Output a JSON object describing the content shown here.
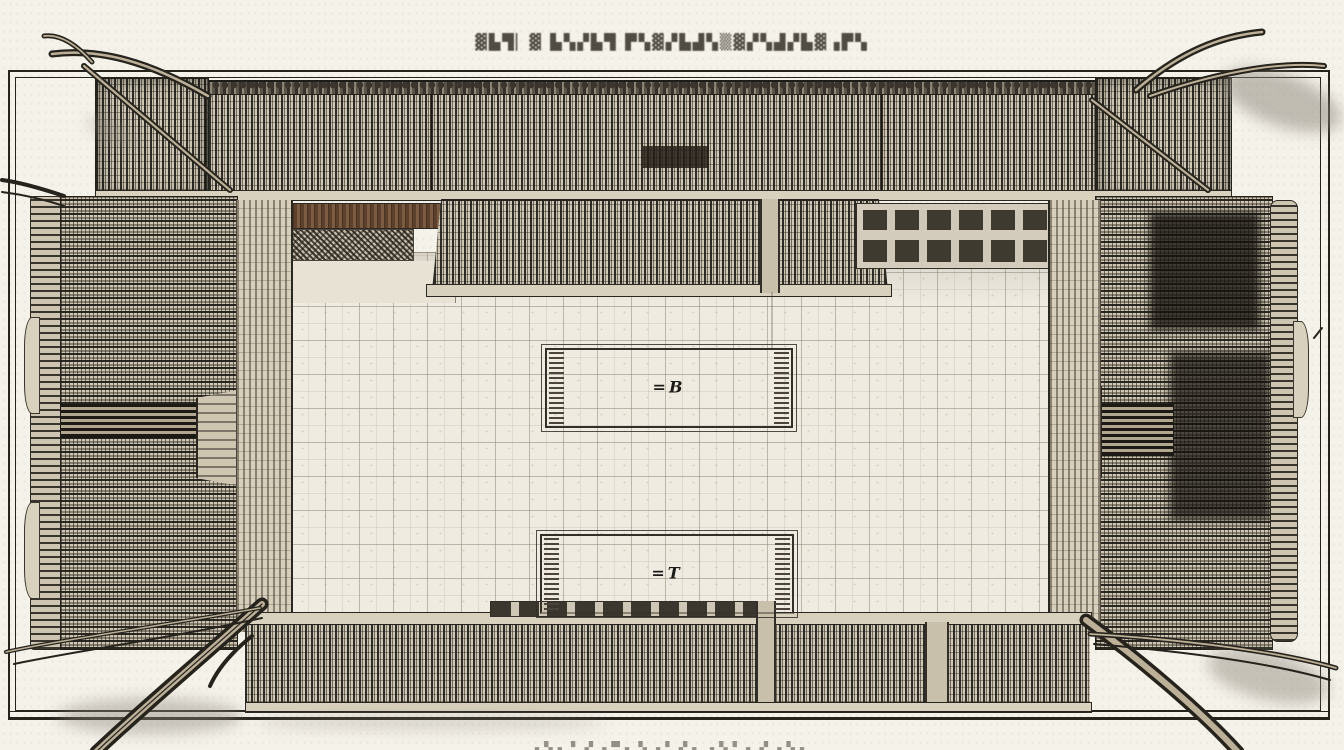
{
  "title": {
    "text": "▓▙▜▏▓ ▙▚▞▙▜ ▛▚▓▞▙▟▚▒▓▞▚▟▞▙▓▗▛▚"
  },
  "courtyard": {
    "platform_upper_label": "=B",
    "platform_lower_label": "=T"
  },
  "caption": {
    "text": "▗▚▖▘▞▗▀▖▚▗▘▞▖▗▚▘▖▞▗▚▖"
  },
  "colors": {
    "paper": "#f5f2ea",
    "ink": "#26231d",
    "eave": "#d8d1be",
    "courtyard": "#efebe1",
    "shadow": "#8b8579",
    "wood": "#6f4f38"
  }
}
